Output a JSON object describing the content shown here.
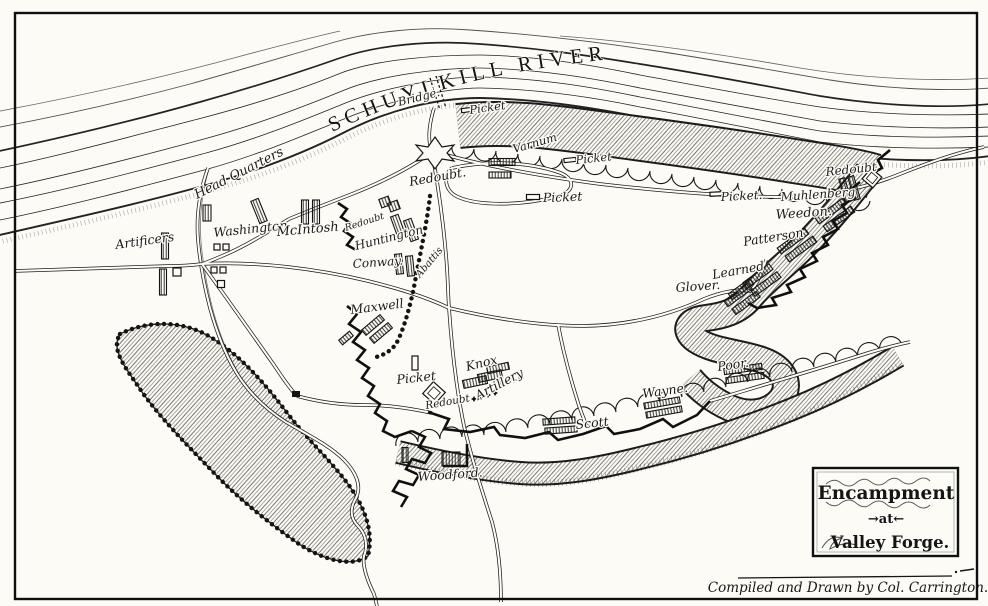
{
  "canvas": {
    "paper_color": "#fcfbf6",
    "ink_color": "#1b1b1b"
  },
  "map": {
    "river_label": "SCHUYLKILL RIVER",
    "bridge_label": "Bridge.",
    "labels": {
      "head_quarters": "Head Quarters",
      "artificers": "Artificers",
      "washington": "Washington",
      "mcintosh": "McIntosh",
      "redoubt_small": "Redoubt",
      "huntington": "Huntington",
      "conway": "Conway.",
      "abattis": "Abattis",
      "maxwell": "Maxwell",
      "picket_west": "Picket",
      "redoubt_south": "Redoubt",
      "knox": "Knox",
      "artillery": "Artillery",
      "woodford": "Woodford.",
      "scott": "Scott",
      "wayne": "Wayne.",
      "poor": "Poor.",
      "glover": "Glover.",
      "learned": "Learned",
      "patterson": "Patterson",
      "weedon": "Weedon.",
      "muhlenberg": "Muhlenberg",
      "redoubt_east": "Redoubt",
      "picket_east": "Picket.",
      "picket_north": "Picket",
      "varnum": "Varnum",
      "picket_mid_east": "Picket",
      "picket_mid": "Picket",
      "redoubt_north": "Redoubt."
    },
    "cartouche": {
      "line1": "Encampment",
      "line2": "→at←",
      "line3": "Valley Forge."
    },
    "credit": "Compiled and Drawn by Col. Carrington."
  }
}
